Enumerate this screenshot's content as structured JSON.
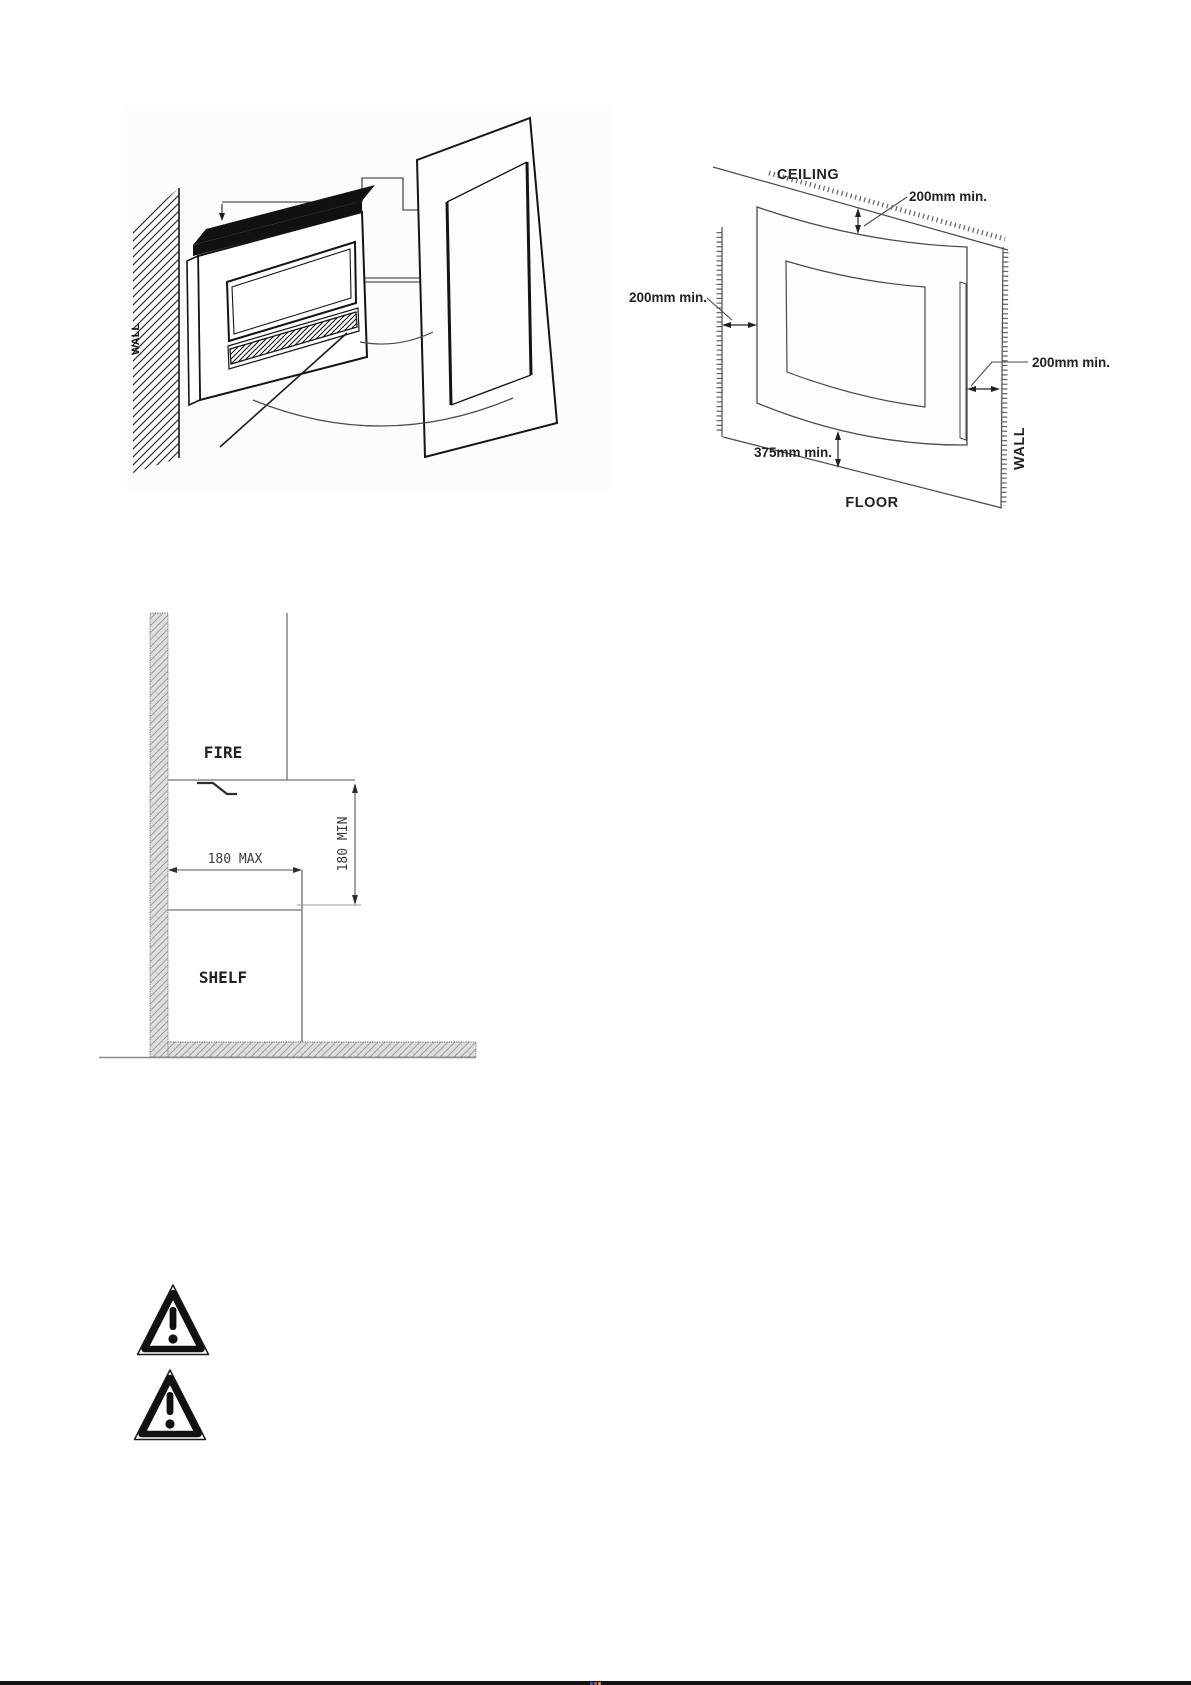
{
  "isometric_figure": {
    "description": "isometric view of fire unit beside wall panel with cut-out",
    "wall_label": "WALL"
  },
  "clearance_figure": {
    "ceiling_label": "CEILING",
    "floor_label": "FLOOR",
    "wall_label": "WALL",
    "top_clearance": "200mm min.",
    "left_clearance": "200mm min.",
    "right_clearance": "200mm min.",
    "bottom_clearance": "375mm min."
  },
  "shelf_figure": {
    "fire_label": "FIRE",
    "shelf_label": "SHELF",
    "shelf_depth_dim": "180 MAX",
    "shelf_distance_dim": "180 MIN"
  },
  "warning_icons": [
    {
      "name": "warning-triangle-icon"
    },
    {
      "name": "warning-triangle-icon"
    }
  ],
  "colors": {
    "drawing_line": "#4a4a4a",
    "dark_line": "#141414",
    "hatch_fill": "#dedede",
    "footer_bar": "#141414",
    "footer_dot_blue": "#4060c8",
    "footer_dot_red": "#c05050",
    "footer_dot_yellow": "#c8a040"
  }
}
